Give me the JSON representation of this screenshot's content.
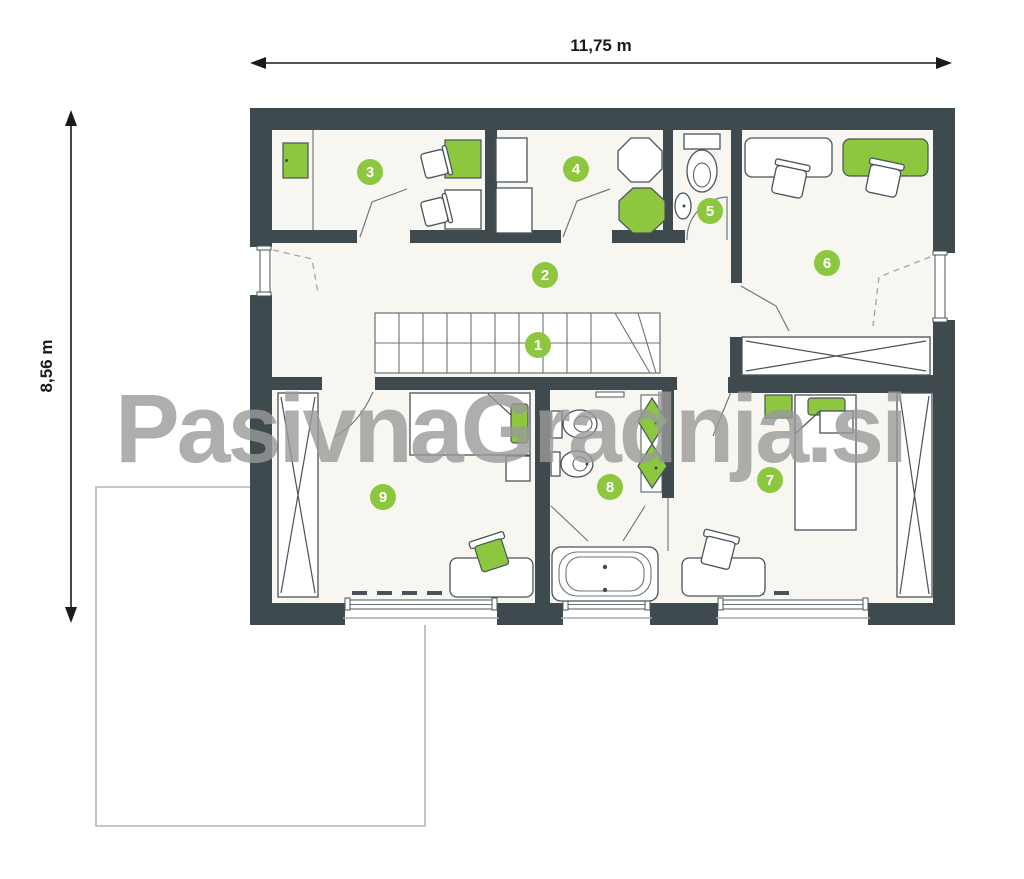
{
  "dimensions": {
    "width_label": "11,75 m",
    "height_label": "8,56 m"
  },
  "watermark": {
    "text": "PasivnaGradnja.si"
  },
  "rooms": [
    {
      "number": "1"
    },
    {
      "number": "2"
    },
    {
      "number": "3"
    },
    {
      "number": "4"
    },
    {
      "number": "5"
    },
    {
      "number": "6"
    },
    {
      "number": "7"
    },
    {
      "number": "8"
    },
    {
      "number": "9"
    }
  ],
  "colors": {
    "wall": "#3e4a4d",
    "floor": "#f7f6f1",
    "accent_green": "#8dc63f",
    "watermark_gray": "#9a9a9a",
    "terrace_outline": "#b3b3b3",
    "dimension_text": "#1a1a1a"
  }
}
